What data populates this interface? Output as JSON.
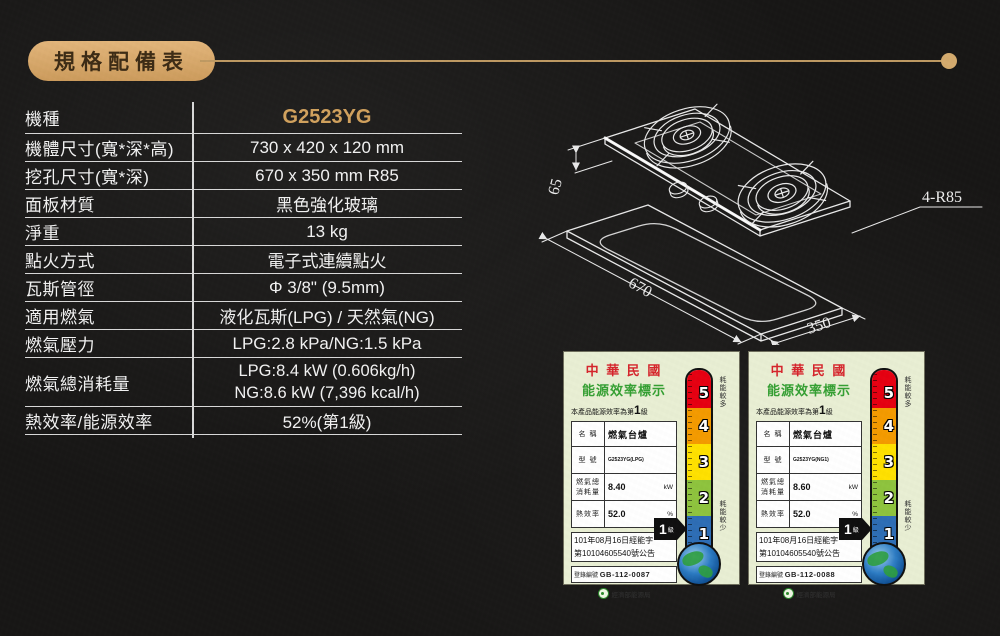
{
  "header": {
    "title": "規格配備表"
  },
  "colors": {
    "background": "#181716",
    "accent_gold": "#d2a25e",
    "table_line": "#d9d9d9",
    "label_background": "#e9efd4",
    "thermometer": [
      "#e60012",
      "#f49b00",
      "#ffe100",
      "#8fc43e",
      "#2e6eb6"
    ]
  },
  "spec_table": {
    "rows": [
      {
        "label": "機種",
        "value": "G2523YG"
      },
      {
        "label": "機體尺寸(寬*深*高)",
        "value": "730 x 420 x 120 mm"
      },
      {
        "label": "挖孔尺寸(寬*深)",
        "value": "670 x 350 mm R85"
      },
      {
        "label": "面板材質",
        "value": "黑色強化玻璃"
      },
      {
        "label": "淨重",
        "value": "13 kg"
      },
      {
        "label": "點火方式",
        "value": "電子式連續點火"
      },
      {
        "label": "瓦斯管徑",
        "value": "Φ 3/8\" (9.5mm)"
      },
      {
        "label": "適用燃氣",
        "value": "液化瓦斯(LPG) / 天然氣(NG)"
      },
      {
        "label": "燃氣壓力",
        "value": "LPG:2.8 kPa/NG:1.5 kPa"
      },
      {
        "label": "燃氣總消耗量",
        "value": "LPG:8.4 kW (0.606kg/h)",
        "value2": "NG:8.6 kW (7,396 kcal/h)"
      },
      {
        "label": "熱效率/能源效率",
        "value": "52%(第1級)"
      }
    ]
  },
  "diagram": {
    "dim_height": "65",
    "dim_width": "670",
    "dim_depth": "350",
    "corner_radius": "4-R85"
  },
  "thermometer": {
    "levels": [
      {
        "num": "5",
        "color": "#e60012"
      },
      {
        "num": "4",
        "color": "#f49b00"
      },
      {
        "num": "3",
        "color": "#ffe100"
      },
      {
        "num": "2",
        "color": "#8fc43e"
      },
      {
        "num": "1",
        "color": "#2e6eb6"
      }
    ],
    "high_label": "耗能較多",
    "low_label": "耗能較少",
    "pointer_grade": "1",
    "pointer_unit": "級"
  },
  "energy_labels": [
    {
      "country": "中 華 民 國",
      "title": "能源效率標示",
      "grade_sentence_prefix": "本產品能源效率為第",
      "grade": "1",
      "grade_sentence_suffix": "級",
      "name_label": "名 稱",
      "name_value": "燃氣台爐",
      "model_label": "型 號",
      "model_value": "G2523YG(LPG)",
      "consumption_label_line1": "燃氣總",
      "consumption_label_line2": "消耗量",
      "consumption_value": "8.40",
      "consumption_unit": "kW",
      "efficiency_label": "熱效率",
      "efficiency_value": "52.0",
      "efficiency_unit": "%",
      "announcement_line1": "101年08月16日經能字",
      "announcement_line2": "第10104605540號公告",
      "registry_label": "登錄編號",
      "registry_value": "GB-112-0087",
      "agency": "經濟部能源局"
    },
    {
      "country": "中 華 民 國",
      "title": "能源效率標示",
      "grade_sentence_prefix": "本產品能源效率為第",
      "grade": "1",
      "grade_sentence_suffix": "級",
      "name_label": "名 稱",
      "name_value": "燃氣台爐",
      "model_label": "型 號",
      "model_value": "G2523YG(NG1)",
      "consumption_label_line1": "燃氣總",
      "consumption_label_line2": "消耗量",
      "consumption_value": "8.60",
      "consumption_unit": "kW",
      "efficiency_label": "熱效率",
      "efficiency_value": "52.0",
      "efficiency_unit": "%",
      "announcement_line1": "101年08月16日經能字",
      "announcement_line2": "第10104605540號公告",
      "registry_label": "登錄編號",
      "registry_value": "GB-112-0088",
      "agency": "經濟部能源局"
    }
  ]
}
